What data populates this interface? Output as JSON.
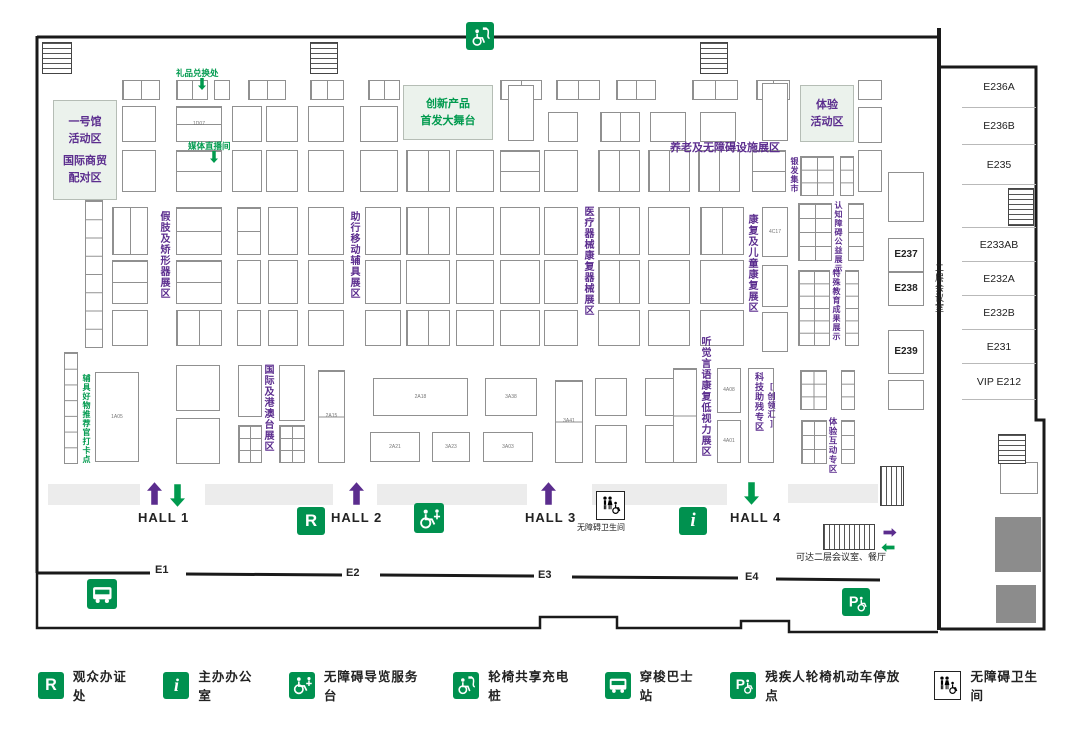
{
  "colors": {
    "green": "#00914f",
    "light_green": "#ebf2ec",
    "purple": "#5b2d8e",
    "wall": "#1a1a1a",
    "booth_border": "#909090",
    "gray_block": "#8c8c8c",
    "aisle": "#ececec"
  },
  "map": {
    "zones": [
      {
        "lines": [
          "一号馆",
          "活动区",
          "",
          "国际商贸",
          "配对区"
        ],
        "color": "#5b2d8e",
        "x": 53,
        "y": 100,
        "w": 64,
        "h": 100,
        "fs": 11
      },
      {
        "lines": [
          "创新产品",
          "首发大舞台"
        ],
        "color": "#009a4e",
        "x": 403,
        "y": 85,
        "w": 90,
        "h": 55,
        "fs": 11
      },
      {
        "lines": [
          "体验",
          "活动区"
        ],
        "color": "#5b2d8e",
        "x": 800,
        "y": 85,
        "w": 54,
        "h": 57,
        "fs": 11
      }
    ],
    "zone_labels": [
      {
        "t": "假肢及矫形器展区",
        "x": 156,
        "y": 211,
        "c": "p",
        "dir": "v",
        "fs": 10
      },
      {
        "t": "助行移动辅具展区",
        "x": 346,
        "y": 211,
        "c": "p",
        "dir": "v",
        "fs": 10
      },
      {
        "t": "医疗器械康复器械展区",
        "x": 580,
        "y": 206,
        "c": "p",
        "dir": "v",
        "fs": 10
      },
      {
        "t": "康复及儿童康复展区",
        "x": 744,
        "y": 214,
        "c": "p",
        "dir": "v",
        "fs": 10
      },
      {
        "t": "听觉言语康复低视力展区",
        "x": 697,
        "y": 336,
        "c": "p",
        "dir": "v",
        "fs": 10
      },
      {
        "t": "国际及港澳台展区",
        "x": 260,
        "y": 364,
        "c": "p",
        "dir": "v",
        "fs": 10
      },
      {
        "t": "科技助残专区",
        "x": 753,
        "y": 372,
        "c": "p",
        "dir": "v",
        "fs": 9
      },
      {
        "t": "[创领汇]",
        "x": 766,
        "y": 382,
        "c": "p",
        "dir": "v",
        "fs": 8
      },
      {
        "t": "银发集市",
        "x": 789,
        "y": 157,
        "c": "p",
        "dir": "v",
        "fs": 8
      },
      {
        "t": "认知障碍公益展示",
        "x": 833,
        "y": 201,
        "c": "p",
        "dir": "v",
        "fs": 8
      },
      {
        "t": "特殊教育成果展示",
        "x": 831,
        "y": 269,
        "c": "p",
        "dir": "v",
        "fs": 8
      },
      {
        "t": "体验互动专区",
        "x": 827,
        "y": 417,
        "c": "p",
        "dir": "v",
        "fs": 8.5
      },
      {
        "t": "养老及无障碍设施展区",
        "x": 670,
        "y": 139,
        "c": "p",
        "dir": "h",
        "fs": 11
      },
      {
        "t": "辅具好物推荐官打卡点",
        "x": 81,
        "y": 374,
        "c": "g",
        "dir": "v",
        "fs": 8
      },
      {
        "t": "礼品兑换处",
        "x": 176,
        "y": 67,
        "c": "g",
        "dir": "h",
        "fs": 8.5
      },
      {
        "t": "媒体直播间",
        "x": 188,
        "y": 140,
        "c": "g",
        "dir": "h",
        "fs": 8.5
      },
      {
        "t": "二层会议室",
        "x": 933,
        "y": 263,
        "c": "k",
        "dir": "v",
        "fs": 9
      },
      {
        "t": "无障碍卫生间",
        "x": 577,
        "y": 522,
        "c": "k",
        "dir": "h",
        "fs": 8
      },
      {
        "t": "可达二层会议室、餐厅",
        "x": 796,
        "y": 550,
        "c": "k",
        "dir": "h",
        "fs": 9
      }
    ],
    "halls": [
      {
        "label": "HALL 1",
        "x": 138,
        "y": 510,
        "arrows": [
          [
            "up",
            "#5b2d8e",
            147,
            482
          ],
          [
            "down",
            "#009a4e",
            170,
            484
          ]
        ]
      },
      {
        "label": "HALL 2",
        "x": 331,
        "y": 510,
        "arrows": [
          [
            "up",
            "#5b2d8e",
            349,
            482
          ]
        ]
      },
      {
        "label": "HALL 3",
        "x": 525,
        "y": 510,
        "arrows": [
          [
            "up",
            "#5b2d8e",
            541,
            482
          ]
        ]
      },
      {
        "label": "HALL 4",
        "x": 730,
        "y": 510,
        "arrows": [
          [
            "down",
            "#009a4e",
            744,
            482
          ]
        ]
      }
    ],
    "entrances": [
      {
        "label": "E1",
        "x": 155,
        "y": 564
      },
      {
        "label": "E2",
        "x": 346,
        "y": 567
      },
      {
        "label": "E3",
        "x": 538,
        "y": 569
      },
      {
        "label": "E4",
        "x": 745,
        "y": 571
      }
    ],
    "esc_arrows": [
      [
        "right",
        "#5b2d8e",
        880,
        526
      ],
      [
        "left",
        "#009a4e",
        878,
        541
      ]
    ],
    "small_arrows": [
      [
        198,
        77
      ],
      [
        210,
        150
      ]
    ],
    "rooms": [
      {
        "label": "E236A",
        "h": 41
      },
      {
        "label": "E236B",
        "h": 37
      },
      {
        "label": "E235",
        "h": 40
      },
      {
        "label": "",
        "h": 43
      },
      {
        "label": "E233AB",
        "h": 34
      },
      {
        "label": "E232A",
        "h": 34
      },
      {
        "label": "E232B",
        "h": 34
      },
      {
        "label": "E231",
        "h": 34
      },
      {
        "label": "VIP E212",
        "h": 36
      }
    ],
    "floor_icons": [
      {
        "t": "charge",
        "x": 466,
        "y": 22,
        "s": 28
      },
      {
        "t": "r",
        "x": 297,
        "y": 507,
        "s": 28
      },
      {
        "t": "guide",
        "x": 414,
        "y": 503,
        "s": 30
      },
      {
        "t": "toilet",
        "x": 596,
        "y": 491,
        "s": 27
      },
      {
        "t": "i",
        "x": 679,
        "y": 507,
        "s": 28
      },
      {
        "t": "bus",
        "x": 87,
        "y": 579,
        "s": 30
      },
      {
        "t": "p",
        "x": 842,
        "y": 588,
        "s": 28
      }
    ],
    "hatches": [
      [
        42,
        42,
        30,
        32,
        "h"
      ],
      [
        310,
        42,
        28,
        32,
        "h"
      ],
      [
        700,
        42,
        28,
        32,
        "h"
      ],
      [
        1008,
        188,
        26,
        38,
        "h"
      ],
      [
        998,
        434,
        28,
        30,
        "h"
      ],
      [
        880,
        466,
        24,
        40,
        "v"
      ],
      [
        823,
        524,
        52,
        26,
        "v"
      ]
    ],
    "aisles": [
      [
        48,
        484,
        92,
        21
      ],
      [
        205,
        484,
        128,
        21
      ],
      [
        377,
        484,
        150,
        21
      ],
      [
        592,
        484,
        135,
        21
      ],
      [
        788,
        484,
        90,
        19
      ]
    ],
    "gray_blocks": [
      [
        995,
        517,
        46,
        55
      ],
      [
        996,
        585,
        40,
        38
      ]
    ],
    "booths": [
      [
        122,
        80,
        38,
        20,
        "",
        "g2"
      ],
      [
        176,
        80,
        32,
        20,
        "",
        "g2"
      ],
      [
        214,
        80,
        16,
        20,
        "",
        ""
      ],
      [
        248,
        80,
        38,
        20,
        "",
        "g2"
      ],
      [
        310,
        80,
        34,
        20,
        "",
        "g2"
      ],
      [
        368,
        80,
        32,
        20,
        "",
        "g2"
      ],
      [
        500,
        80,
        42,
        20,
        "",
        "g2"
      ],
      [
        556,
        80,
        44,
        20,
        "",
        "g2"
      ],
      [
        616,
        80,
        40,
        20,
        "",
        "g2"
      ],
      [
        692,
        80,
        46,
        20,
        "",
        "g2"
      ],
      [
        756,
        80,
        34,
        20,
        "",
        "g2"
      ],
      [
        858,
        80,
        24,
        20,
        "",
        ""
      ],
      [
        122,
        106,
        34,
        36,
        "",
        ""
      ],
      [
        176,
        106,
        46,
        36,
        "1D07",
        "g2v"
      ],
      [
        232,
        106,
        30,
        36,
        "",
        ""
      ],
      [
        266,
        106,
        32,
        36,
        "",
        ""
      ],
      [
        308,
        106,
        36,
        36,
        "",
        ""
      ],
      [
        360,
        106,
        38,
        36,
        "",
        ""
      ],
      [
        508,
        85,
        26,
        56,
        "",
        ""
      ],
      [
        548,
        112,
        30,
        30,
        "",
        ""
      ],
      [
        600,
        112,
        40,
        30,
        "",
        "g2"
      ],
      [
        650,
        112,
        36,
        30,
        "",
        ""
      ],
      [
        700,
        112,
        36,
        30,
        "",
        ""
      ],
      [
        762,
        83,
        26,
        58,
        "",
        ""
      ],
      [
        858,
        107,
        24,
        36,
        "",
        ""
      ],
      [
        122,
        150,
        34,
        42,
        "",
        ""
      ],
      [
        176,
        150,
        46,
        42,
        "",
        "g2v"
      ],
      [
        232,
        150,
        30,
        42,
        "",
        ""
      ],
      [
        266,
        150,
        32,
        42,
        "",
        ""
      ],
      [
        308,
        150,
        36,
        42,
        "",
        ""
      ],
      [
        360,
        150,
        38,
        42,
        "",
        ""
      ],
      [
        406,
        150,
        44,
        42,
        "",
        "g2"
      ],
      [
        456,
        150,
        38,
        42,
        "",
        ""
      ],
      [
        500,
        150,
        40,
        42,
        "",
        "g2v"
      ],
      [
        544,
        150,
        34,
        42,
        "",
        ""
      ],
      [
        598,
        150,
        42,
        42,
        "",
        "g2"
      ],
      [
        648,
        150,
        42,
        42,
        "",
        "g2"
      ],
      [
        698,
        150,
        42,
        42,
        "",
        "g2"
      ],
      [
        752,
        150,
        34,
        42,
        "",
        "g2v"
      ],
      [
        800,
        156,
        34,
        40,
        "",
        "g2x3"
      ],
      [
        840,
        156,
        14,
        40,
        "",
        "rows3"
      ],
      [
        858,
        150,
        24,
        42,
        "",
        ""
      ],
      [
        85,
        200,
        18,
        148,
        "",
        "rows8"
      ],
      [
        112,
        207,
        36,
        48,
        "",
        "g2"
      ],
      [
        176,
        207,
        46,
        48,
        "",
        "g2v"
      ],
      [
        237,
        207,
        24,
        48,
        "",
        "g2v"
      ],
      [
        268,
        207,
        30,
        48,
        "",
        ""
      ],
      [
        308,
        207,
        36,
        48,
        "",
        ""
      ],
      [
        365,
        207,
        36,
        48,
        "",
        ""
      ],
      [
        406,
        207,
        44,
        48,
        "",
        "g2"
      ],
      [
        456,
        207,
        38,
        48,
        "",
        ""
      ],
      [
        500,
        207,
        40,
        48,
        "",
        ""
      ],
      [
        544,
        207,
        34,
        48,
        "",
        ""
      ],
      [
        598,
        207,
        42,
        48,
        "",
        "g2"
      ],
      [
        648,
        207,
        42,
        48,
        "",
        ""
      ],
      [
        700,
        207,
        44,
        48,
        "",
        "g2"
      ],
      [
        762,
        207,
        26,
        50,
        "4C17",
        ""
      ],
      [
        798,
        203,
        34,
        58,
        "",
        "g2x4"
      ],
      [
        848,
        203,
        16,
        58,
        "",
        "rows4"
      ],
      [
        112,
        260,
        36,
        44,
        "",
        "g2v"
      ],
      [
        176,
        260,
        46,
        44,
        "",
        "g2v"
      ],
      [
        237,
        260,
        24,
        44,
        "",
        ""
      ],
      [
        268,
        260,
        30,
        44,
        "",
        ""
      ],
      [
        308,
        260,
        36,
        44,
        "",
        ""
      ],
      [
        365,
        260,
        36,
        44,
        "",
        ""
      ],
      [
        406,
        260,
        44,
        44,
        "",
        ""
      ],
      [
        456,
        260,
        38,
        44,
        "",
        ""
      ],
      [
        500,
        260,
        40,
        44,
        "",
        ""
      ],
      [
        544,
        260,
        34,
        44,
        "",
        ""
      ],
      [
        598,
        260,
        42,
        44,
        "",
        "g2"
      ],
      [
        648,
        260,
        42,
        44,
        "",
        ""
      ],
      [
        700,
        260,
        44,
        44,
        "",
        ""
      ],
      [
        762,
        265,
        26,
        42,
        "",
        ""
      ],
      [
        798,
        270,
        32,
        76,
        "",
        "g2x6"
      ],
      [
        845,
        270,
        14,
        76,
        "",
        "rows6"
      ],
      [
        112,
        310,
        36,
        36,
        "",
        ""
      ],
      [
        176,
        310,
        46,
        36,
        "",
        "g2"
      ],
      [
        237,
        310,
        24,
        36,
        "",
        ""
      ],
      [
        268,
        310,
        30,
        36,
        "",
        ""
      ],
      [
        308,
        310,
        36,
        36,
        "",
        ""
      ],
      [
        365,
        310,
        36,
        36,
        "",
        ""
      ],
      [
        406,
        310,
        44,
        36,
        "",
        "g2"
      ],
      [
        456,
        310,
        38,
        36,
        "",
        ""
      ],
      [
        500,
        310,
        40,
        36,
        "",
        ""
      ],
      [
        544,
        310,
        34,
        36,
        "",
        ""
      ],
      [
        598,
        310,
        42,
        36,
        "",
        ""
      ],
      [
        648,
        310,
        42,
        36,
        "",
        ""
      ],
      [
        700,
        310,
        44,
        36,
        "",
        ""
      ],
      [
        762,
        312,
        26,
        40,
        "",
        ""
      ],
      [
        64,
        352,
        14,
        112,
        "",
        "rows7"
      ],
      [
        95,
        372,
        44,
        90,
        "1A05",
        ""
      ],
      [
        176,
        365,
        44,
        46,
        "",
        ""
      ],
      [
        176,
        418,
        44,
        46,
        "",
        ""
      ],
      [
        238,
        365,
        24,
        52,
        "",
        ""
      ],
      [
        238,
        425,
        24,
        38,
        "",
        "g2x3"
      ],
      [
        279,
        365,
        26,
        56,
        "",
        ""
      ],
      [
        279,
        425,
        26,
        38,
        "",
        "g2x3"
      ],
      [
        318,
        370,
        27,
        93,
        "2A15",
        "g2v"
      ],
      [
        373,
        378,
        95,
        38,
        "2A18",
        ""
      ],
      [
        485,
        378,
        52,
        38,
        "3A38",
        ""
      ],
      [
        370,
        432,
        50,
        30,
        "2A21",
        ""
      ],
      [
        432,
        432,
        38,
        30,
        "3A23",
        ""
      ],
      [
        483,
        432,
        50,
        30,
        "3A03",
        ""
      ],
      [
        555,
        380,
        28,
        83,
        "3A41",
        "g2v"
      ],
      [
        595,
        378,
        32,
        38,
        "",
        ""
      ],
      [
        645,
        378,
        40,
        38,
        "",
        ""
      ],
      [
        595,
        425,
        32,
        38,
        "",
        ""
      ],
      [
        645,
        425,
        40,
        38,
        "",
        ""
      ],
      [
        673,
        368,
        24,
        95,
        "",
        "g2v"
      ],
      [
        717,
        368,
        24,
        45,
        "4A08",
        ""
      ],
      [
        717,
        420,
        24,
        43,
        "4A01",
        ""
      ],
      [
        748,
        368,
        26,
        95,
        "",
        ""
      ],
      [
        800,
        370,
        27,
        40,
        "",
        "g2x3"
      ],
      [
        841,
        370,
        14,
        40,
        "",
        "rows3"
      ],
      [
        801,
        420,
        26,
        44,
        "",
        "g2x3"
      ],
      [
        841,
        420,
        14,
        44,
        "",
        "rows3"
      ],
      [
        888,
        172,
        36,
        50,
        "",
        ""
      ],
      [
        888,
        238,
        36,
        34,
        "E237",
        "room"
      ],
      [
        888,
        272,
        36,
        34,
        "E238",
        "room"
      ],
      [
        888,
        330,
        36,
        44,
        "E239",
        "room"
      ],
      [
        888,
        380,
        36,
        30,
        "",
        ""
      ],
      [
        1000,
        462,
        38,
        32,
        "",
        ""
      ]
    ]
  },
  "legend": {
    "items": [
      {
        "icon": "r",
        "label": "观众办证处"
      },
      {
        "icon": "i",
        "label": "主办办公室"
      },
      {
        "icon": "guide",
        "label": "无障碍导览服务台"
      },
      {
        "icon": "charge",
        "label": "轮椅共享充电桩"
      },
      {
        "icon": "bus",
        "label": "穿梭巴士站"
      },
      {
        "icon": "p",
        "label": "残疾人轮椅机动车停放点"
      },
      {
        "icon": "toilet",
        "label": "无障碍卫生间"
      }
    ]
  }
}
